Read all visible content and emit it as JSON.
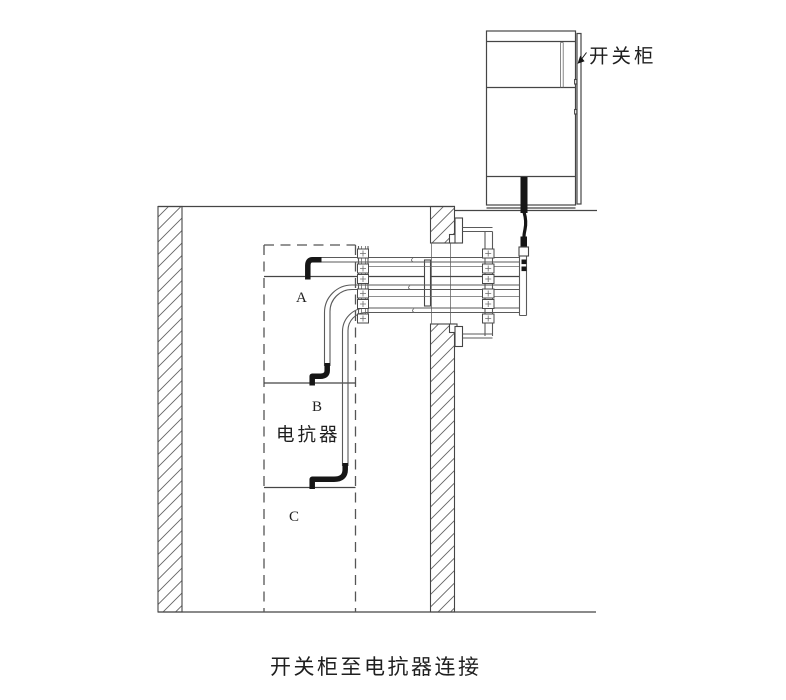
{
  "diagram": {
    "caption": "开关柜至电抗器连接",
    "labels": {
      "cabinet": "开关柜",
      "reactor": "电抗器",
      "phase_a": "A",
      "phase_b": "B",
      "phase_c": "C"
    },
    "colors": {
      "background": "#ffffff",
      "line": "#454545",
      "thin_line": "#5a5a5a",
      "conductor_black": "#161616",
      "text": "#1f1f1f"
    }
  }
}
